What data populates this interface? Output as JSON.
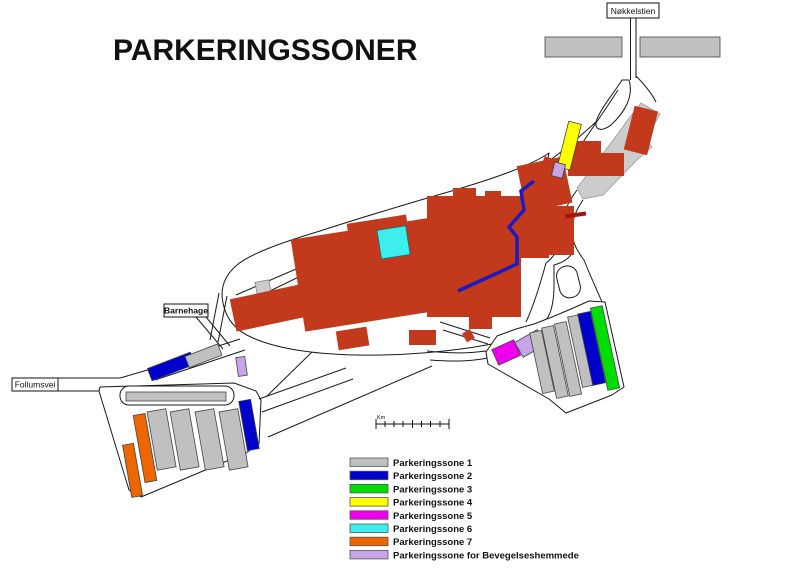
{
  "title": "PARKERINGSSONER",
  "labels": {
    "nokkelstien": "Nøkkelstien",
    "barnehage": "Barnehage",
    "follumsvei": "Follumsvei"
  },
  "scale_bar": {
    "unit": "Km"
  },
  "colors": {
    "zone1": "#c0c0c0",
    "zone2": "#0000cc",
    "zone3": "#00dd00",
    "zone4": "#ffff00",
    "zone5": "#ee00ee",
    "zone6": "#3deeee",
    "zone7": "#ee6600",
    "disabled": "#c8a5e8",
    "building": "#c2391b",
    "route": "#1c1cbe",
    "road_gray": "#cccccc",
    "marker_red": "#aa1111",
    "outline": "#1a1a1a"
  },
  "legend": {
    "items": [
      {
        "label": "Parkeringssone 1",
        "color": "#c0c0c0"
      },
      {
        "label": "Parkeringssone 2",
        "color": "#0000cc"
      },
      {
        "label": "Parkeringssone 3",
        "color": "#00dd00"
      },
      {
        "label": "Parkeringssone 4",
        "color": "#ffff00"
      },
      {
        "label": "Parkeringssone 5",
        "color": "#ee00ee"
      },
      {
        "label": "Parkeringssone 6",
        "color": "#3deeee"
      },
      {
        "label": "Parkeringssone 7",
        "color": "#ee6600"
      },
      {
        "label": "Parkeringssone for Bevegelseshemmede",
        "color": "#c8a5e8"
      }
    ]
  }
}
